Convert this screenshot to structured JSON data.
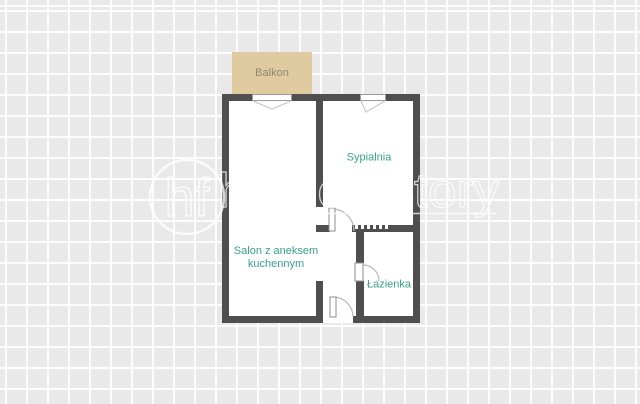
{
  "balcony": {
    "label": "Balkon"
  },
  "rooms": {
    "salon": {
      "label": "Salon z aneksem kuchennym"
    },
    "sypialnia": {
      "label": "Sypialnia"
    },
    "lazienka": {
      "label": "Łazienka"
    }
  },
  "watermark": {
    "logo": "hf",
    "brand": "homefactory"
  },
  "colors": {
    "background": "#e9e9e9",
    "grid_line": "#ffffff",
    "wall": "#4f4f4f",
    "room_fill": "#ffffff",
    "balcony_fill": "#e0cba1",
    "balcony_label": "#8e8773",
    "room_label": "#38a28a",
    "door_symbol": "#b9b9b9"
  }
}
